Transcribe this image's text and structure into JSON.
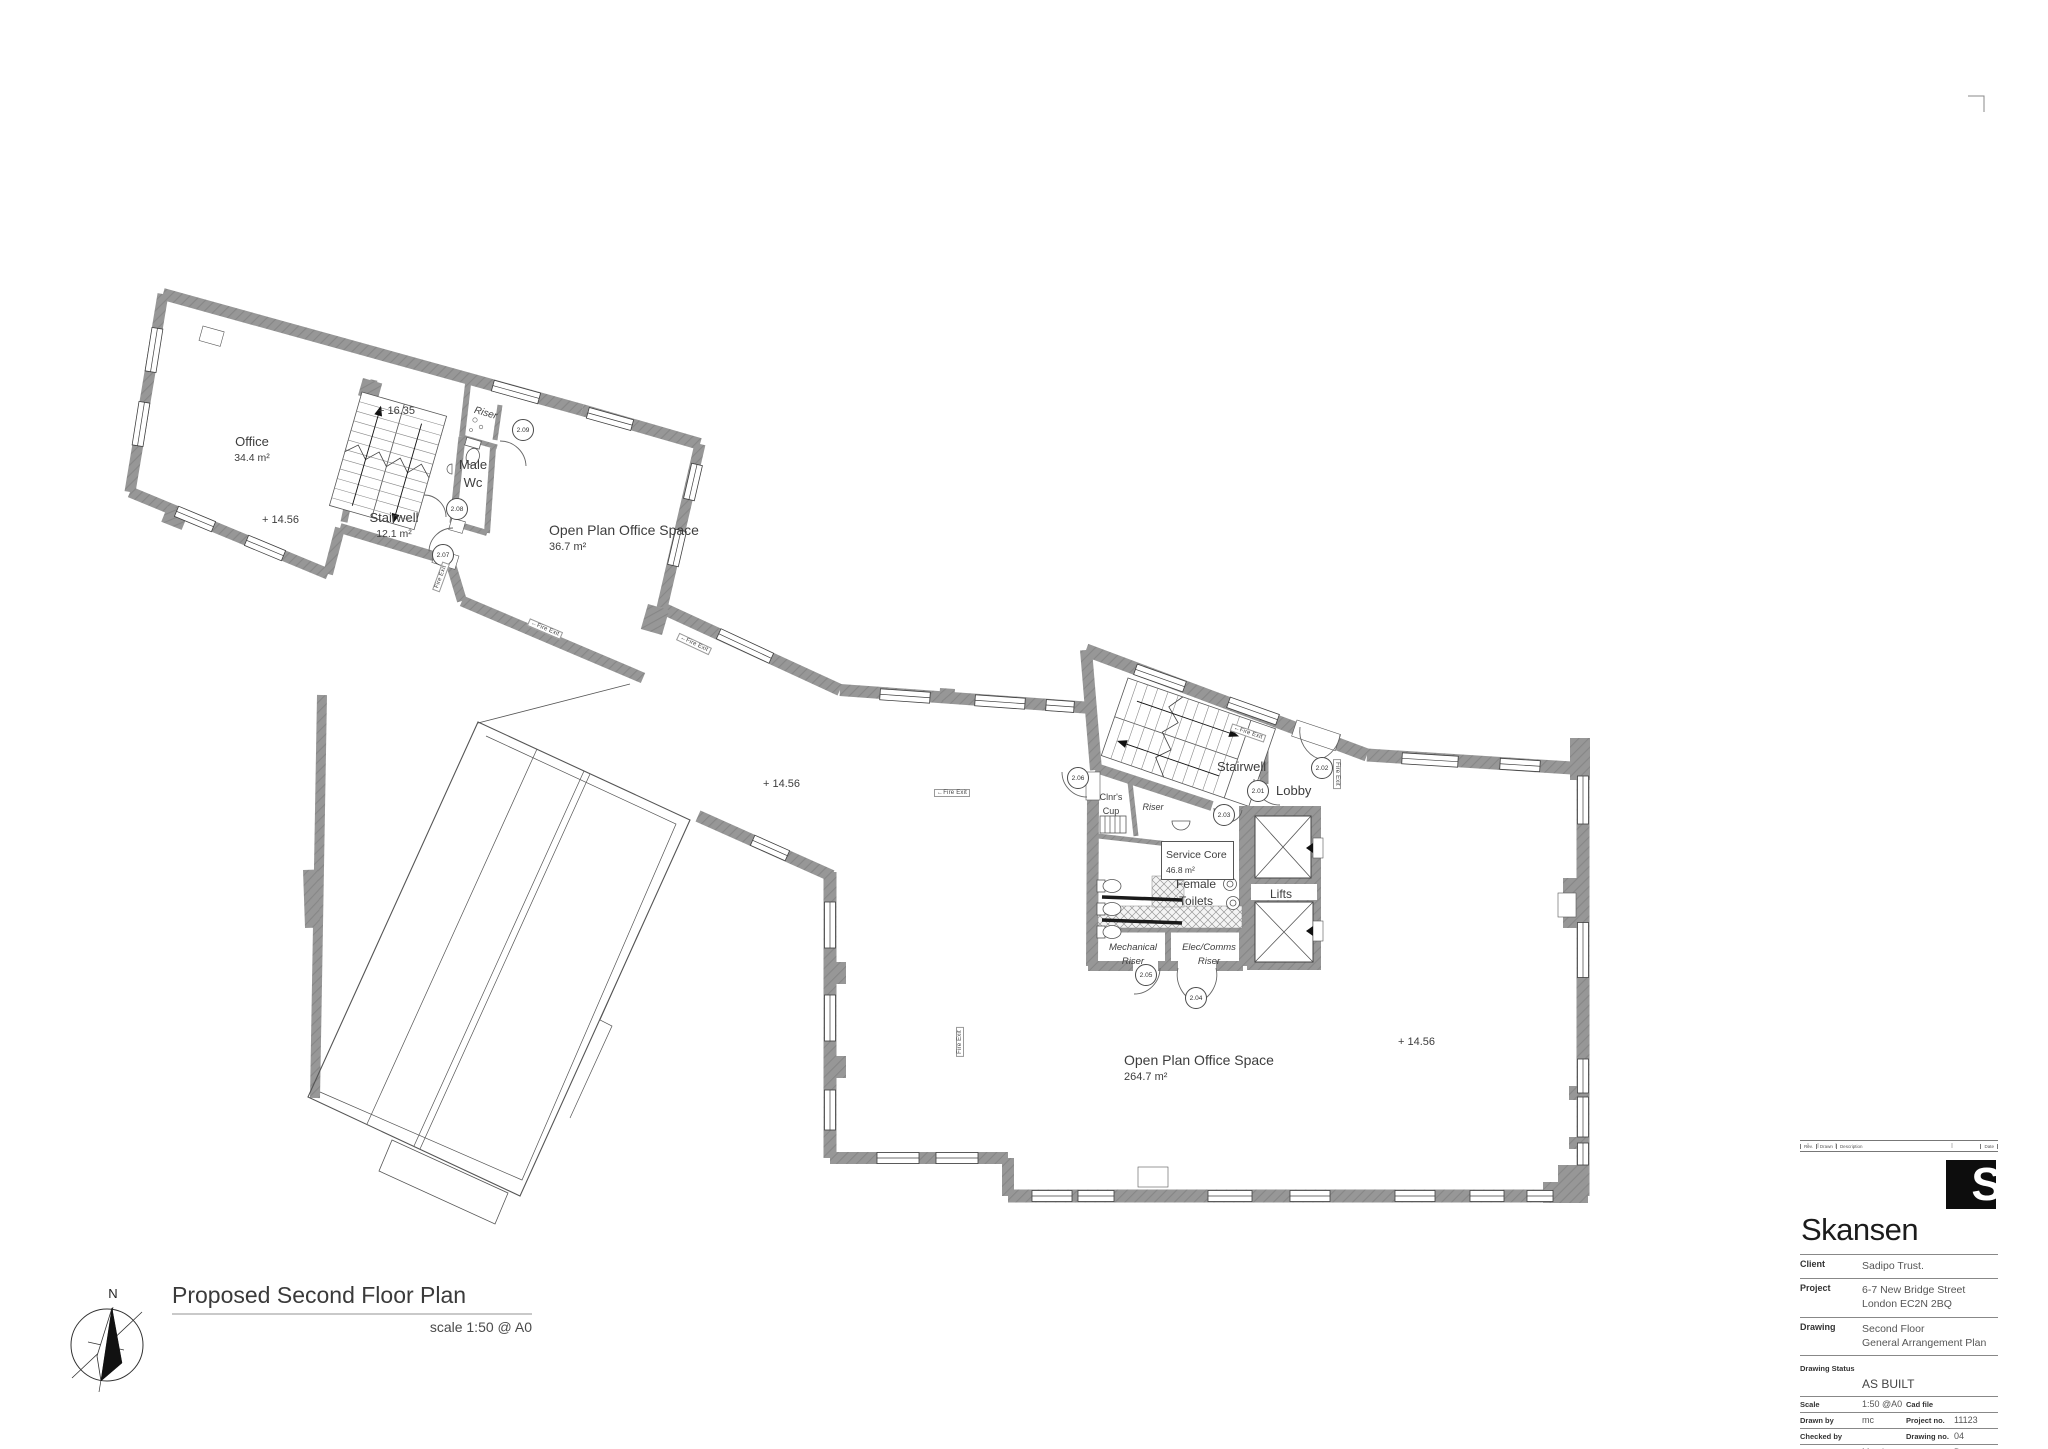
{
  "plan": {
    "title": "Proposed Second Floor Plan",
    "scale_note": "scale 1:50 @ A0",
    "north_label": "N",
    "labels": [
      {
        "name": "room-office",
        "lines": [
          "Office",
          "34.4 m²"
        ],
        "x": 252,
        "y": 432,
        "size": 13,
        "sub": 10.5,
        "align": "center",
        "rot": 0,
        "italic": false,
        "boxed": false
      },
      {
        "name": "room-stairwell-upper",
        "lines": [
          "Stairwell",
          "12.1 m²"
        ],
        "x": 394,
        "y": 508,
        "size": 13,
        "sub": 10.5,
        "align": "center",
        "rot": 0,
        "italic": false,
        "boxed": false
      },
      {
        "name": "room-male-wc",
        "lines": [
          "Male",
          "Wc"
        ],
        "x": 473,
        "y": 455,
        "size": 13,
        "sub": 13,
        "align": "center",
        "rot": 0,
        "italic": false,
        "boxed": false
      },
      {
        "name": "room-riser-upper",
        "lines": [
          "Riser"
        ],
        "x": 486,
        "y": 402,
        "size": 10,
        "sub": 10,
        "align": "center",
        "rot": 16,
        "italic": true,
        "boxed": false
      },
      {
        "name": "room-openplan-small",
        "lines": [
          "Open Plan Office Space",
          "36.7 m²"
        ],
        "x": 549,
        "y": 521,
        "size": 14,
        "sub": 11,
        "align": "left",
        "rot": 0,
        "italic": false,
        "boxed": false
      },
      {
        "name": "level-16-35",
        "lines": [
          "+ 16.35"
        ],
        "x": 378,
        "y": 400,
        "size": 11,
        "sub": 11,
        "align": "left",
        "rot": 0,
        "italic": false,
        "boxed": false
      },
      {
        "name": "level-14-56-office",
        "lines": [
          "+ 14.56"
        ],
        "x": 262,
        "y": 509,
        "size": 11,
        "sub": 11,
        "align": "left",
        "rot": 0,
        "italic": false,
        "boxed": false
      },
      {
        "name": "level-14-56-mid",
        "lines": [
          "+ 14.56"
        ],
        "x": 763,
        "y": 773,
        "size": 11,
        "sub": 11,
        "align": "left",
        "rot": 0,
        "italic": false,
        "boxed": false
      },
      {
        "name": "level-14-56-main",
        "lines": [
          "+ 14.56"
        ],
        "x": 1398,
        "y": 1031,
        "size": 11,
        "sub": 11,
        "align": "left",
        "rot": 0,
        "italic": false,
        "boxed": false
      },
      {
        "name": "room-stairwell-core",
        "lines": [
          "Stairwell"
        ],
        "x": 1217,
        "y": 757,
        "size": 13,
        "sub": 13,
        "align": "left",
        "rot": 0,
        "italic": false,
        "boxed": false
      },
      {
        "name": "room-lobby",
        "lines": [
          "Lobby"
        ],
        "x": 1276,
        "y": 781,
        "size": 13,
        "sub": 13,
        "align": "left",
        "rot": 0,
        "italic": false,
        "boxed": false
      },
      {
        "name": "room-clnrs-cup",
        "lines": [
          "Clnr's",
          "Cup"
        ],
        "x": 1111,
        "y": 786,
        "size": 9,
        "sub": 9,
        "align": "center",
        "rot": 0,
        "italic": false,
        "boxed": false
      },
      {
        "name": "room-riser-core",
        "lines": [
          "Riser"
        ],
        "x": 1153,
        "y": 796,
        "size": 9,
        "sub": 9,
        "align": "center",
        "rot": 0,
        "italic": true,
        "boxed": false
      },
      {
        "name": "room-service-core",
        "lines": [
          "Service Core",
          "46.8 m²"
        ],
        "x": 1161,
        "y": 841,
        "size": 10.5,
        "sub": 8.5,
        "align": "left",
        "rot": 0,
        "italic": false,
        "boxed": true
      },
      {
        "name": "room-female-toilets",
        "lines": [
          "Female",
          "Toilets"
        ],
        "x": 1196,
        "y": 874,
        "size": 12,
        "sub": 12,
        "align": "center",
        "rot": 0,
        "italic": false,
        "boxed": false
      },
      {
        "name": "room-lifts",
        "lines": [
          "Lifts"
        ],
        "x": 1281,
        "y": 884,
        "size": 12,
        "sub": 12,
        "align": "center",
        "rot": 0,
        "italic": false,
        "boxed": false
      },
      {
        "name": "room-mechanical-riser",
        "lines": [
          "Mechanical",
          "Riser"
        ],
        "x": 1133,
        "y": 936,
        "size": 9.5,
        "sub": 9.5,
        "align": "center",
        "rot": 0,
        "italic": true,
        "boxed": false
      },
      {
        "name": "room-elec-comms-riser",
        "lines": [
          "Elec/Comms",
          "Riser"
        ],
        "x": 1209,
        "y": 936,
        "size": 9.5,
        "sub": 9.5,
        "align": "center",
        "rot": 0,
        "italic": true,
        "boxed": false
      },
      {
        "name": "room-openplan-large",
        "lines": [
          "Open Plan Office Space",
          "264.7 m²"
        ],
        "x": 1124,
        "y": 1051,
        "size": 14,
        "sub": 11,
        "align": "left",
        "rot": 0,
        "italic": false,
        "boxed": false
      }
    ],
    "door_tags": [
      {
        "id": "2.09",
        "x": 523,
        "y": 430
      },
      {
        "id": "2.08",
        "x": 457,
        "y": 509
      },
      {
        "id": "2.07",
        "x": 443,
        "y": 555
      },
      {
        "id": "2.06",
        "x": 1078,
        "y": 778
      },
      {
        "id": "2.05",
        "x": 1146,
        "y": 975
      },
      {
        "id": "2.04",
        "x": 1196,
        "y": 998
      },
      {
        "id": "2.03",
        "x": 1224,
        "y": 815
      },
      {
        "id": "2.01",
        "x": 1258,
        "y": 791
      },
      {
        "id": "2.02",
        "x": 1322,
        "y": 768
      }
    ],
    "fire_exits": [
      {
        "text": "←Fire Exit",
        "x": 545,
        "y": 629,
        "rot": 23
      },
      {
        "text": "←Fire Exit",
        "x": 694,
        "y": 644,
        "rot": 25
      },
      {
        "text": "Fire Exit",
        "x": 441,
        "y": 577,
        "rot": -70
      },
      {
        "text": "←Fire Exit",
        "x": 952,
        "y": 793,
        "rot": 0
      },
      {
        "text": "←Fire Exit",
        "x": 1248,
        "y": 733,
        "rot": 19
      },
      {
        "text": "Fire Exit",
        "x": 1337,
        "y": 774,
        "rot": 90
      },
      {
        "text": "Fire Exit",
        "x": 960,
        "y": 1042,
        "rot": -90
      }
    ]
  },
  "title_block": {
    "brand": "Skansen",
    "logo_letter": "S",
    "revision_strip": {
      "rev": "Rev.",
      "drawn": "Drawn",
      "description": "Description",
      "date": "Date"
    },
    "rows": [
      {
        "label": "Client",
        "value_lines": [
          "Sadipo Trust."
        ]
      },
      {
        "label": "Project",
        "value_lines": [
          "6-7 New Bridge Street",
          "London EC2N 2BQ"
        ]
      },
      {
        "label": "Drawing",
        "value_lines": [
          "Second Floor",
          "General Arrangement Plan"
        ]
      }
    ],
    "status_row": {
      "label": "Drawing Status",
      "value": "AS BUILT"
    },
    "grid_rows": [
      {
        "label": "Scale",
        "value": "1:50 @A0",
        "label2": "Cad file",
        "value2": ""
      },
      {
        "label": "Drawn by",
        "value": "mc",
        "label2": "Project no.",
        "value2": "11123"
      },
      {
        "label": "Checked by",
        "value": "",
        "label2": "Drawing no.",
        "value2": "04"
      },
      {
        "label": "Date",
        "value": "March 2012",
        "label2": "Revision",
        "value2": "D"
      }
    ]
  }
}
